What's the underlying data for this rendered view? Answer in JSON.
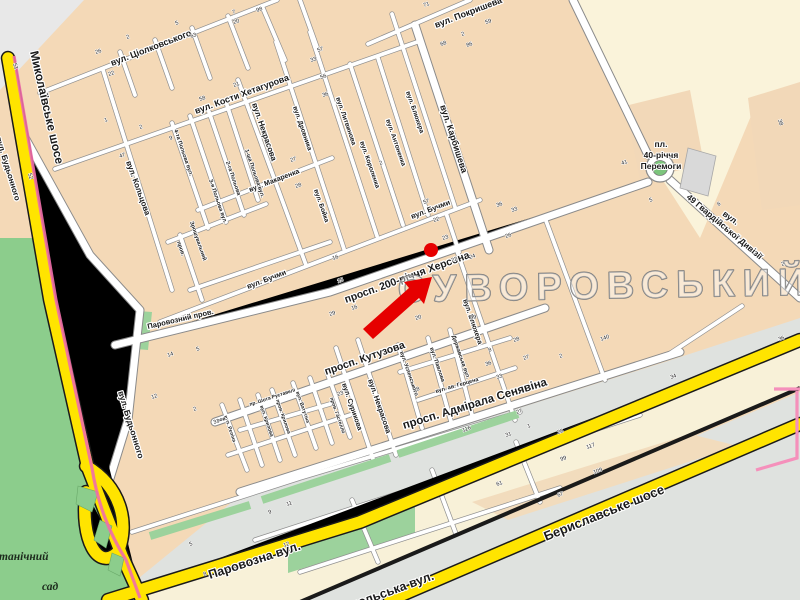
{
  "map": {
    "district_label": "СУВОРОВСЬКИЙ",
    "marker": {
      "kind": "red-arrow-with-dot",
      "dot_x": 431,
      "dot_y": 250
    },
    "colors": {
      "block_tan": "#f4d9b7",
      "open_cream": "#f8f1d8",
      "park_green": "#8ccd8c",
      "strip_green": "#9cd29c",
      "grey_zone": "#dfe2df",
      "road_yellow": "#ffe400",
      "railway_black": "#1a1a1a",
      "tram_pink": "#f06daa",
      "marker_red": "#e60000",
      "roundabout_green": "#7cc47c",
      "building_grey": "#d9d9d9"
    },
    "labels": [
      {
        "id": "mykolaivske-shose",
        "t": "Миколаївське шосе",
        "x": 30,
        "y": 52,
        "r": 77,
        "s": 12,
        "c": "c-road"
      },
      {
        "id": "budonnogo",
        "t": "вул. Будьонного",
        "x": 118,
        "y": 392,
        "r": 73,
        "s": 8.5,
        "c": ""
      },
      {
        "id": "budonnogo-edge",
        "t": "вул. Будьонного",
        "x": -4,
        "y": 138,
        "r": 73,
        "s": 8,
        "c": ""
      },
      {
        "id": "tsiolkovskogo",
        "t": "вул. Ціолковського",
        "x": 112,
        "y": 66,
        "r": -21,
        "s": 9,
        "c": ""
      },
      {
        "id": "pokrysheva",
        "t": "вул. Покришева",
        "x": 436,
        "y": 28,
        "r": -21,
        "s": 9,
        "c": ""
      },
      {
        "id": "khetagurova",
        "t": "вул. Кости Хетагурова",
        "x": 196,
        "y": 114,
        "r": -20,
        "s": 9,
        "c": ""
      },
      {
        "id": "makarenka",
        "t": "вул. Макаренка",
        "x": 250,
        "y": 192,
        "r": -21,
        "s": 7,
        "c": ""
      },
      {
        "id": "koltsova",
        "t": "вул. Кольцова",
        "x": 126,
        "y": 162,
        "r": 70,
        "s": 8,
        "c": ""
      },
      {
        "id": "polova-4",
        "t": "4-та Польова вул.",
        "x": 174,
        "y": 130,
        "r": 71,
        "s": 5.5,
        "c": "c-tiny"
      },
      {
        "id": "polova-3",
        "t": "3-я Польова вул.",
        "x": 209,
        "y": 180,
        "r": 71,
        "s": 5.5,
        "c": "c-tiny"
      },
      {
        "id": "polova-2",
        "t": "2-га Польова",
        "x": 226,
        "y": 162,
        "r": 71,
        "s": 5.5,
        "c": "c-tiny"
      },
      {
        "id": "polova-1",
        "t": "1-ша Польова вул.",
        "x": 245,
        "y": 150,
        "r": 71,
        "s": 5.5,
        "c": "c-tiny"
      },
      {
        "id": "prov-north",
        "t": "пров.",
        "x": 177,
        "y": 242,
        "r": 71,
        "s": 5.5,
        "c": "c-tiny"
      },
      {
        "id": "zroshuvalnyi",
        "t": "Зрошувальний",
        "x": 190,
        "y": 222,
        "r": 71,
        "s": 5.5,
        "c": "c-tiny"
      },
      {
        "id": "nekrasova-n",
        "t": "вул. Некрасова",
        "x": 252,
        "y": 104,
        "r": 71,
        "s": 8,
        "c": ""
      },
      {
        "id": "drovnyka",
        "t": "вул. Дровника",
        "x": 293,
        "y": 107,
        "r": 71,
        "s": 6.5,
        "c": ""
      },
      {
        "id": "boika",
        "t": "вул. Бойка",
        "x": 314,
        "y": 190,
        "r": 71,
        "s": 6.5,
        "c": ""
      },
      {
        "id": "lytvynova",
        "t": "вул. Литвинова",
        "x": 336,
        "y": 98,
        "r": 71,
        "s": 6.5,
        "c": ""
      },
      {
        "id": "korolenka",
        "t": "вул. Короленка",
        "x": 360,
        "y": 142,
        "r": 71,
        "s": 6.5,
        "c": ""
      },
      {
        "id": "antonenka",
        "t": "вул. Антоненка",
        "x": 386,
        "y": 120,
        "r": 71,
        "s": 6.5,
        "c": ""
      },
      {
        "id": "bliukhera-n",
        "t": "вул. Блюхера",
        "x": 406,
        "y": 92,
        "r": 71,
        "s": 6.5,
        "c": ""
      },
      {
        "id": "karbysheva",
        "t": "вул. Карбишева",
        "x": 440,
        "y": 106,
        "r": 72,
        "s": 9,
        "c": ""
      },
      {
        "id": "buchmy-w",
        "t": "вул. Бучми",
        "x": 248,
        "y": 289,
        "r": -21,
        "s": 7.5,
        "c": ""
      },
      {
        "id": "buchmy-e",
        "t": "вул. Бучми",
        "x": 412,
        "y": 219,
        "r": -21,
        "s": 7.5,
        "c": ""
      },
      {
        "id": "prosp-200",
        "t": "просп. 200-річчя Херсона",
        "x": 346,
        "y": 303,
        "r": -20,
        "s": 10.5,
        "c": ""
      },
      {
        "id": "parovoznyi-prov",
        "t": "Паровозний пров.",
        "x": 148,
        "y": 329,
        "r": -13,
        "s": 7.5,
        "c": ""
      },
      {
        "id": "kutuzova",
        "t": "просп. Кутузова",
        "x": 326,
        "y": 375,
        "r": -19,
        "s": 10.5,
        "c": ""
      },
      {
        "id": "nekrasova-s",
        "t": "вул. Некрасова",
        "x": 368,
        "y": 380,
        "r": 71,
        "s": 7.5,
        "c": ""
      },
      {
        "id": "surykova",
        "t": "вул. Сурикова",
        "x": 342,
        "y": 384,
        "r": 71,
        "s": 7,
        "c": ""
      },
      {
        "id": "riepina",
        "t": "вул. Рєпіна",
        "x": 224,
        "y": 416,
        "r": 71,
        "s": 5,
        "c": "c-tiny"
      },
      {
        "id": "prov-s",
        "t": "пров.",
        "x": 214,
        "y": 423,
        "r": -15,
        "s": 5,
        "c": "c-tiny"
      },
      {
        "id": "krylova",
        "t": "вул. Крилова",
        "x": 260,
        "y": 406,
        "r": 71,
        "s": 5,
        "c": "c-tiny"
      },
      {
        "id": "prov-krylova",
        "t": "пров. Крилова",
        "x": 276,
        "y": 400,
        "r": 71,
        "s": 5,
        "c": "c-tiny"
      },
      {
        "id": "vatutina",
        "t": "вул. Ватутіна",
        "x": 296,
        "y": 392,
        "r": 71,
        "s": 5,
        "c": "c-tiny"
      },
      {
        "id": "rustaveli",
        "t": "пр. Шота Руставелі",
        "x": 250,
        "y": 406,
        "r": -18,
        "s": 5,
        "c": "c-tiny"
      },
      {
        "id": "gastello",
        "t": "пров. Гастелло",
        "x": 330,
        "y": 398,
        "r": 71,
        "s": 5,
        "c": "c-tiny"
      },
      {
        "id": "uspenskogo",
        "t": "вул. Успенського",
        "x": 400,
        "y": 352,
        "r": 71,
        "s": 5.5,
        "c": "c-tiny"
      },
      {
        "id": "pavlova",
        "t": "вул. Павлова",
        "x": 430,
        "y": 348,
        "r": 71,
        "s": 5.5,
        "c": "c-tiny"
      },
      {
        "id": "gertsena",
        "t": "вул. ав. Герцена",
        "x": 436,
        "y": 393,
        "r": -16,
        "s": 5.5,
        "c": "c-tiny"
      },
      {
        "id": "derzhavska",
        "t": "Державська вул.",
        "x": 452,
        "y": 336,
        "r": 71,
        "s": 5.5,
        "c": "c-tiny"
      },
      {
        "id": "bliukhera-s",
        "t": "вул. Блюхера",
        "x": 463,
        "y": 300,
        "r": 71,
        "s": 7,
        "c": ""
      },
      {
        "id": "seniavina",
        "t": "просп. Адмірала Сенявіна",
        "x": 404,
        "y": 429,
        "r": -17,
        "s": 11.5,
        "c": ""
      },
      {
        "id": "pl",
        "t": "пл.",
        "x": 661,
        "y": 147,
        "r": 0,
        "s": 8.5,
        "c": "c-place",
        "a": "middle"
      },
      {
        "id": "pl-40",
        "t": "40-річчя",
        "x": 661,
        "y": 158,
        "r": 0,
        "s": 8.5,
        "c": "c-place",
        "a": "middle"
      },
      {
        "id": "pl-peremogy",
        "t": "Перемоги",
        "x": 661,
        "y": 169,
        "r": 0,
        "s": 8.5,
        "c": "c-place",
        "a": "middle"
      },
      {
        "id": "gv-49",
        "t": "49 Гвардійської Дивізії",
        "x": 686,
        "y": 198,
        "r": 40,
        "s": 8.5,
        "c": ""
      },
      {
        "id": "gv-49-vul",
        "t": "вул.",
        "x": 722,
        "y": 215,
        "r": 36,
        "s": 8.5,
        "c": ""
      },
      {
        "id": "parovozna",
        "t": "Паровозна вул.",
        "x": 210,
        "y": 579,
        "r": -18,
        "s": 12.5,
        "c": "c-road"
      },
      {
        "id": "beryslavske",
        "t": "Бериславське шосе",
        "x": 546,
        "y": 541,
        "r": -22,
        "s": 13,
        "c": "c-road"
      },
      {
        "id": "nikopolska",
        "t": "Нікопольська вул.",
        "x": 328,
        "y": 618,
        "r": -20,
        "s": 12.5,
        "c": "c-road"
      },
      {
        "id": "botanichnyi",
        "t": "Ботанічний",
        "x": -14,
        "y": 560,
        "r": 0,
        "s": 11.5,
        "c": "c-garden"
      },
      {
        "id": "sad",
        "t": "сад",
        "x": 42,
        "y": 590,
        "r": 0,
        "s": 11.5,
        "c": "c-garden"
      },
      {
        "id": "district",
        "t": "СУВОРОВСЬКИЙ",
        "x": 398,
        "y": 302,
        "r": -1,
        "s": 38,
        "c": "c-district"
      }
    ],
    "house_numbers": [
      [
        "51",
        13,
        64,
        70
      ],
      [
        "26",
        96,
        54
      ],
      [
        "22",
        109,
        76
      ],
      [
        "2",
        127,
        39
      ],
      [
        "5",
        176,
        25
      ],
      [
        "7",
        233,
        14
      ],
      [
        "20",
        234,
        24
      ],
      [
        "63",
        191,
        38
      ],
      [
        "98",
        257,
        12
      ],
      [
        "21",
        234,
        87
      ],
      [
        "58",
        200,
        101
      ],
      [
        "57",
        318,
        52
      ],
      [
        "33",
        311,
        62
      ],
      [
        "56",
        321,
        79
      ],
      [
        "36",
        323,
        97
      ],
      [
        "71",
        424,
        7
      ],
      [
        "59",
        486,
        24
      ],
      [
        "68",
        441,
        46
      ],
      [
        "2",
        462,
        36
      ],
      [
        "86",
        467,
        47
      ],
      [
        "47",
        120,
        158
      ],
      [
        "52",
        28,
        174,
        70
      ],
      [
        "1",
        105,
        122
      ],
      [
        "2",
        140,
        129
      ],
      [
        "9",
        170,
        140
      ],
      [
        "27",
        291,
        162
      ],
      [
        "28",
        296,
        188
      ],
      [
        "2",
        380,
        165
      ],
      [
        "57",
        424,
        204
      ],
      [
        "22",
        434,
        222
      ],
      [
        "23",
        443,
        240
      ],
      [
        "22",
        452,
        262
      ],
      [
        "24",
        470,
        259
      ],
      [
        "26",
        506,
        238
      ],
      [
        "33",
        512,
        212
      ],
      [
        "36",
        497,
        207
      ],
      [
        "16",
        333,
        260
      ],
      [
        "15",
        338,
        283
      ],
      [
        "29",
        330,
        316
      ],
      [
        "16",
        352,
        310
      ],
      [
        "20",
        416,
        320
      ],
      [
        "99",
        471,
        320
      ],
      [
        "28",
        514,
        342
      ],
      [
        "27",
        524,
        360
      ],
      [
        "8",
        489,
        352
      ],
      [
        "23",
        338,
        396
      ],
      [
        "31",
        506,
        437
      ],
      [
        "1",
        528,
        428
      ],
      [
        "116",
        463,
        432
      ],
      [
        "33",
        497,
        379
      ],
      [
        "36",
        486,
        366
      ],
      [
        "8",
        417,
        391
      ],
      [
        "140",
        601,
        341
      ],
      [
        "34",
        671,
        379
      ],
      [
        "36",
        779,
        341
      ],
      [
        "27",
        517,
        414
      ],
      [
        "28",
        558,
        434
      ],
      [
        "99",
        561,
        461
      ],
      [
        "61",
        497,
        486
      ],
      [
        "117",
        587,
        449
      ],
      [
        "109",
        594,
        474
      ],
      [
        "67",
        558,
        497
      ],
      [
        "5",
        197,
        351
      ],
      [
        "14",
        168,
        357
      ],
      [
        "12",
        152,
        399
      ],
      [
        "2",
        194,
        411
      ],
      [
        "31",
        214,
        424
      ],
      [
        "5",
        190,
        546
      ],
      [
        "8",
        204,
        576
      ],
      [
        "9",
        269,
        514
      ],
      [
        "11",
        287,
        506
      ],
      [
        "12",
        284,
        547
      ],
      [
        "41",
        622,
        165
      ],
      [
        "5",
        650,
        202
      ],
      [
        "6",
        718,
        206
      ],
      [
        "2",
        782,
        266
      ],
      [
        "38",
        778,
        120,
        70
      ],
      [
        "2",
        560,
        358
      ]
    ]
  }
}
